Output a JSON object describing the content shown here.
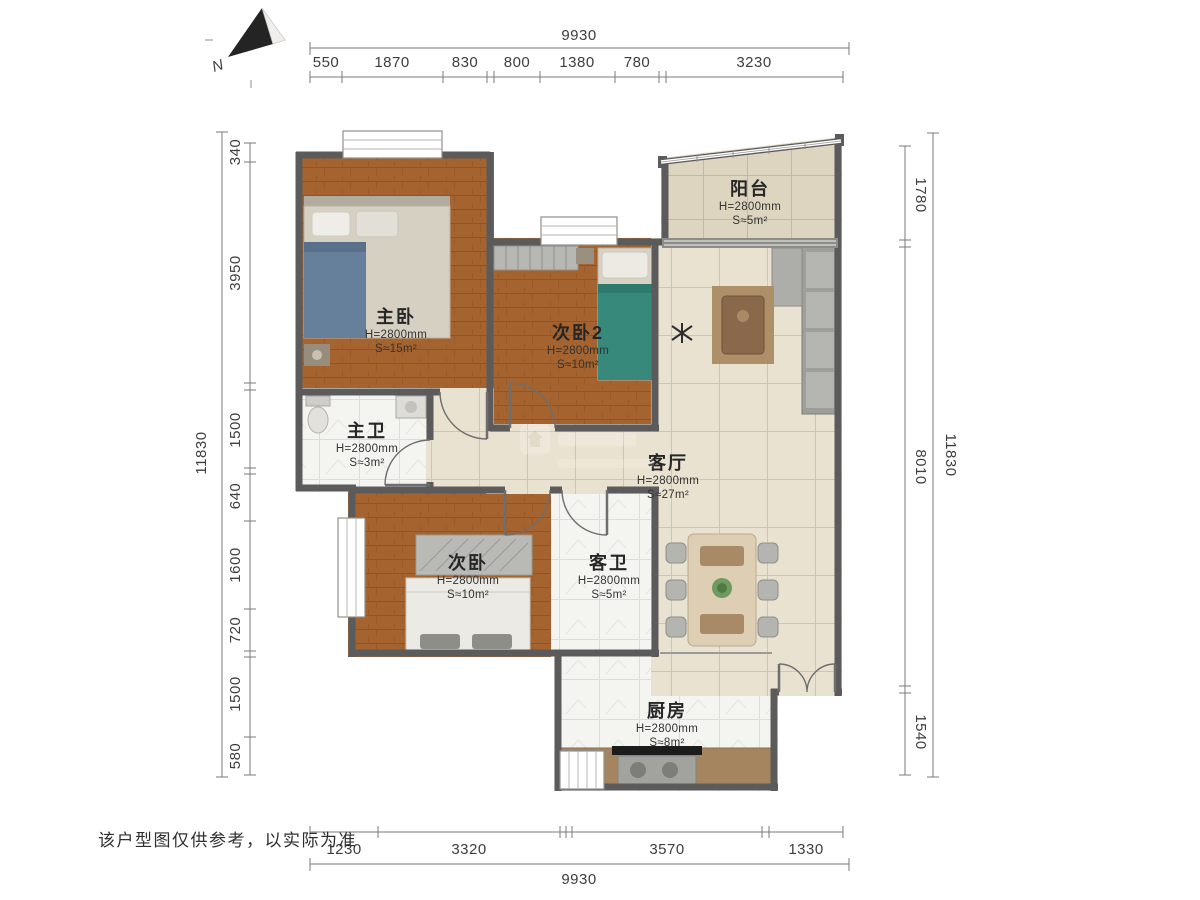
{
  "meta": {
    "north_label": "N",
    "disclaimer": "该户型图仅供参考，以实际为准"
  },
  "palette": {
    "wood_floor": "#a4632f",
    "living_tile": "#eae2d0",
    "balcony_tile": "#ddd5bf",
    "bath_tile": "#f4f4f1",
    "wall": "#5b5b5b",
    "dimension_text": "#3d3d3d"
  },
  "rooms": [
    {
      "id": "master-bedroom",
      "name": "主卧",
      "height": "H=2800mm",
      "area": "S≈15m²"
    },
    {
      "id": "bedroom-2",
      "name": "次卧2",
      "height": "H=2800mm",
      "area": "S≈10m²"
    },
    {
      "id": "balcony",
      "name": "阳台",
      "height": "H=2800mm",
      "area": "S≈5m²"
    },
    {
      "id": "master-bath",
      "name": "主卫",
      "height": "H=2800mm",
      "area": "S≈3m²"
    },
    {
      "id": "living-room",
      "name": "客厅",
      "height": "H=2800mm",
      "area": "S≈27m²"
    },
    {
      "id": "bedroom",
      "name": "次卧",
      "height": "H=2800mm",
      "area": "S≈10m²"
    },
    {
      "id": "guest-bath",
      "name": "客卫",
      "height": "H=2800mm",
      "area": "S≈5m²"
    },
    {
      "id": "kitchen",
      "name": "厨房",
      "height": "H=2800mm",
      "area": "S≈8m²"
    }
  ],
  "dimensions": {
    "top": {
      "total": "9930",
      "segments": [
        "550",
        "1870",
        "830",
        "800",
        "1380",
        "780",
        "3230"
      ]
    },
    "bottom": {
      "total": "9930",
      "segments": [
        "1230",
        "3320",
        "3570",
        "1330"
      ]
    },
    "left": {
      "total": "11830",
      "segments": [
        "340",
        "3950",
        "1500",
        "640",
        "1600",
        "720",
        "1500",
        "580"
      ]
    },
    "right": {
      "total": "11830",
      "segments": [
        "1780",
        "8010",
        "1540"
      ]
    }
  }
}
